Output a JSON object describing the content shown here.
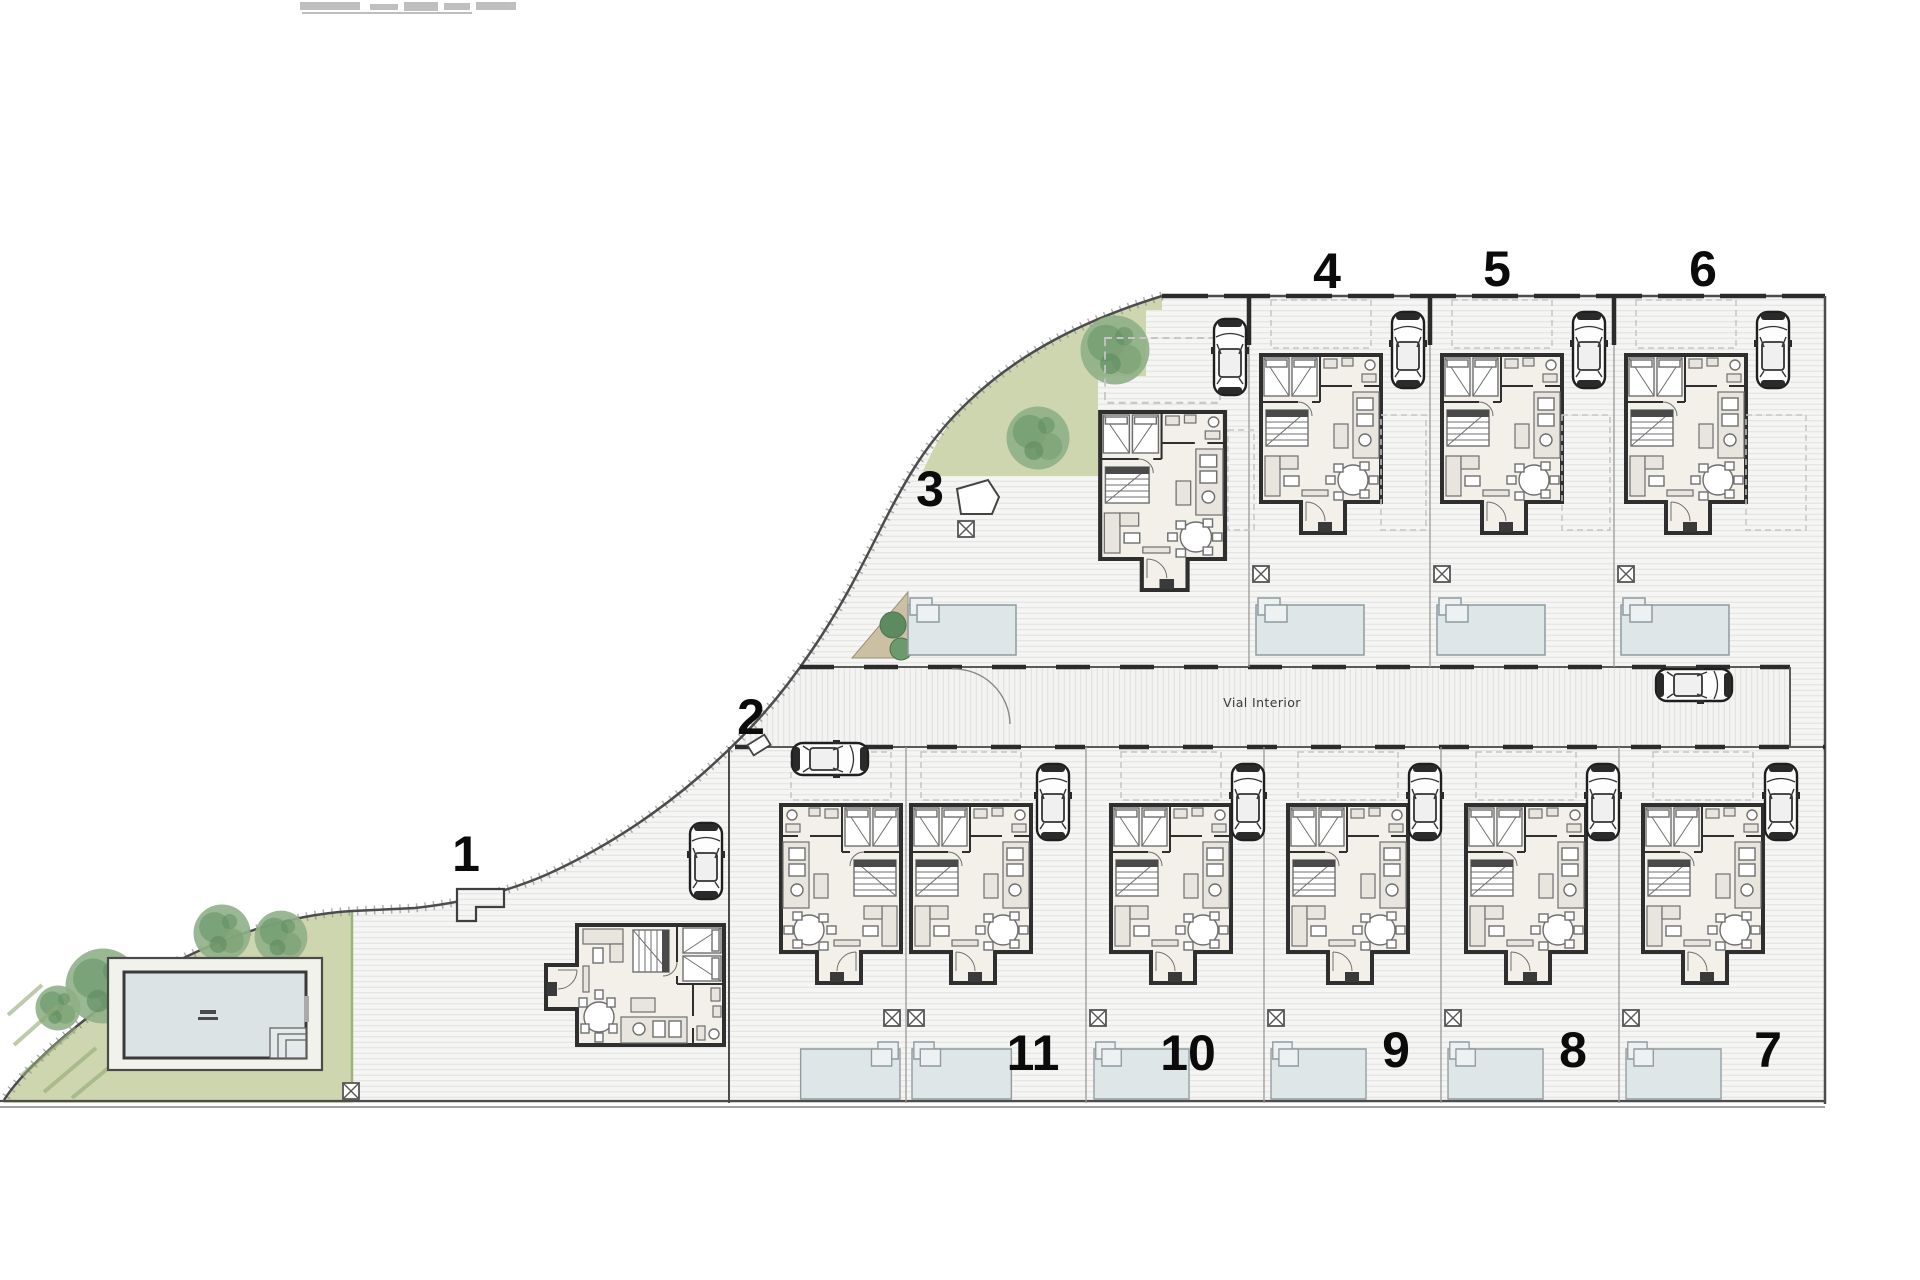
{
  "plan": {
    "road_label": "Vial Interior",
    "plots": [
      {
        "label": "1"
      },
      {
        "label": "2"
      },
      {
        "label": "3"
      },
      {
        "label": "4"
      },
      {
        "label": "5"
      },
      {
        "label": "6"
      },
      {
        "label": "7"
      },
      {
        "label": "8"
      },
      {
        "label": "9"
      },
      {
        "label": "10"
      },
      {
        "label": "11"
      }
    ]
  },
  "colors": {
    "paper": "#ffffff",
    "paving": "#f5f5f4",
    "paving_line": "#e3e3e2",
    "wall": "#2f2f2f",
    "boundary": "#4c4c4c",
    "plot_line": "#999999",
    "lawn": "#cdd6ae",
    "planter": "#cbbfa4",
    "tree": "#7fa377",
    "tree_dark": "#5d8a5f",
    "water": "#dfe6e8",
    "water_edge": "#8f9ba0",
    "interior": "#f3f0ea",
    "furniture": "#6f6f6f",
    "label": "#0b0b0b"
  }
}
